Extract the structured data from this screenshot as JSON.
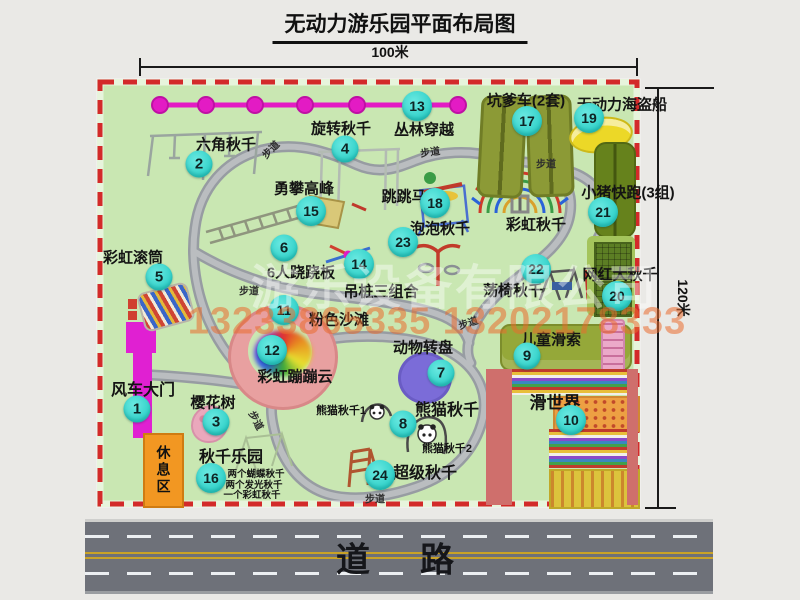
{
  "title": "无动力游乐园平面布局图",
  "dimensions": {
    "width": "100米",
    "height": "120米"
  },
  "road_label": "道　路",
  "rest_area_label": "休息区",
  "rainbow_swing_label": "彩虹秋千",
  "watermark": {
    "company": "游乐设备有限公司",
    "phone": "13233865335 13202178333"
  },
  "colors": {
    "badge_cyan": "#3bd9d1",
    "border_red": "#d32a2a",
    "park_green": "#c9e7b2",
    "zipline_magenta": "#e31bc4",
    "road_gray": "#6e7179",
    "rest_orange": "#f29722"
  },
  "attractions": [
    {
      "num": "1",
      "name": "风车大门",
      "lx": 143,
      "ly": 388,
      "bx": 137,
      "by": 409,
      "fs": 16
    },
    {
      "num": "2",
      "name": "六角秋千",
      "lx": 226,
      "ly": 144,
      "bx": 199,
      "by": 164
    },
    {
      "num": "3",
      "name": "樱花树",
      "lx": 213,
      "ly": 402,
      "bx": 216,
      "by": 422
    },
    {
      "num": "4",
      "name": "旋转秋千",
      "lx": 341,
      "ly": 128,
      "bx": 345,
      "by": 149
    },
    {
      "num": "5",
      "name": "彩虹滚筒",
      "lx": 133,
      "ly": 257,
      "bx": 159,
      "by": 277
    },
    {
      "num": "6",
      "name": "6人跷跷板",
      "lx": 301,
      "ly": 272,
      "bx": 284,
      "by": 248
    },
    {
      "num": "7",
      "name": "动物转盘",
      "lx": 423,
      "ly": 347,
      "bx": 441,
      "by": 373
    },
    {
      "num": "8",
      "name": "熊猫秋千",
      "lx": 447,
      "ly": 408,
      "bx": 403,
      "by": 424,
      "fs": 16
    },
    {
      "num": "9",
      "name": "儿童滑索",
      "lx": 551,
      "ly": 339,
      "bx": 527,
      "by": 356
    },
    {
      "num": "10",
      "name": "滑世界",
      "lx": 555,
      "ly": 401,
      "bx": 571,
      "by": 420,
      "fs": 17
    },
    {
      "num": "11",
      "name": "粉色沙滩",
      "lx": 339,
      "ly": 319,
      "bx": 284,
      "by": 310
    },
    {
      "num": "12",
      "name": "彩虹蹦蹦云",
      "lx": 295,
      "ly": 376,
      "bx": 272,
      "by": 350
    },
    {
      "num": "13",
      "name": "丛林穿越",
      "lx": 424,
      "ly": 129,
      "bx": 417,
      "by": 106
    },
    {
      "num": "14",
      "name": "吊桩三组合",
      "lx": 381,
      "ly": 291,
      "bx": 359,
      "by": 264
    },
    {
      "num": "15",
      "name": "勇攀高峰",
      "lx": 304,
      "ly": 188,
      "bx": 311,
      "by": 211
    },
    {
      "num": "16",
      "name": "秋千乐园",
      "lx": 231,
      "ly": 455,
      "bx": 211,
      "by": 478,
      "fs": 16
    },
    {
      "num": "17",
      "name": "坑爹车(2套)",
      "lx": 526,
      "ly": 100,
      "bx": 527,
      "by": 121
    },
    {
      "num": "18",
      "name": "跳跳马",
      "lx": 404,
      "ly": 196,
      "bx": 435,
      "by": 203
    },
    {
      "num": "19",
      "name": "无动力海盗船",
      "lx": 622,
      "ly": 104,
      "bx": 589,
      "by": 118
    },
    {
      "num": "20",
      "name": "网红大秋千",
      "lx": 620,
      "ly": 274,
      "bx": 617,
      "by": 296
    },
    {
      "num": "21",
      "name": "小猪快跑(3组)",
      "lx": 628,
      "ly": 192,
      "bx": 603,
      "by": 212
    },
    {
      "num": "22",
      "name": "荡椅秋千",
      "lx": 513,
      "ly": 290,
      "bx": 536,
      "by": 269
    },
    {
      "num": "23",
      "name": "泡泡秋千",
      "lx": 440,
      "ly": 228,
      "bx": 403,
      "by": 242
    },
    {
      "num": "24",
      "name": "超级秋千",
      "lx": 425,
      "ly": 471,
      "bx": 380,
      "by": 475,
      "fs": 16
    }
  ],
  "sub_labels": [
    {
      "text": "熊猫秋千1",
      "x": 341,
      "y": 410,
      "cls": "sub"
    },
    {
      "text": "熊猫秋千2",
      "x": 447,
      "y": 448,
      "cls": "sub"
    },
    {
      "text": "两个蝴蝶秋千",
      "x": 256,
      "y": 473,
      "cls": "tiny"
    },
    {
      "text": "两个发光秋千",
      "x": 254,
      "y": 484,
      "cls": "tiny"
    },
    {
      "text": "一个彩虹秋千",
      "x": 252,
      "y": 494,
      "cls": "tiny"
    }
  ],
  "path_labels": [
    {
      "text": "步道",
      "x": 270,
      "y": 149,
      "rot": -45
    },
    {
      "text": "步道",
      "x": 430,
      "y": 151,
      "rot": -8
    },
    {
      "text": "步道",
      "x": 546,
      "y": 163,
      "rot": 0
    },
    {
      "text": "步道",
      "x": 249,
      "y": 290,
      "rot": 0
    },
    {
      "text": "步道",
      "x": 468,
      "y": 322,
      "rot": -18
    },
    {
      "text": "步道",
      "x": 257,
      "y": 420,
      "rot": 62
    },
    {
      "text": "步道",
      "x": 375,
      "y": 498,
      "rot": 0
    }
  ]
}
